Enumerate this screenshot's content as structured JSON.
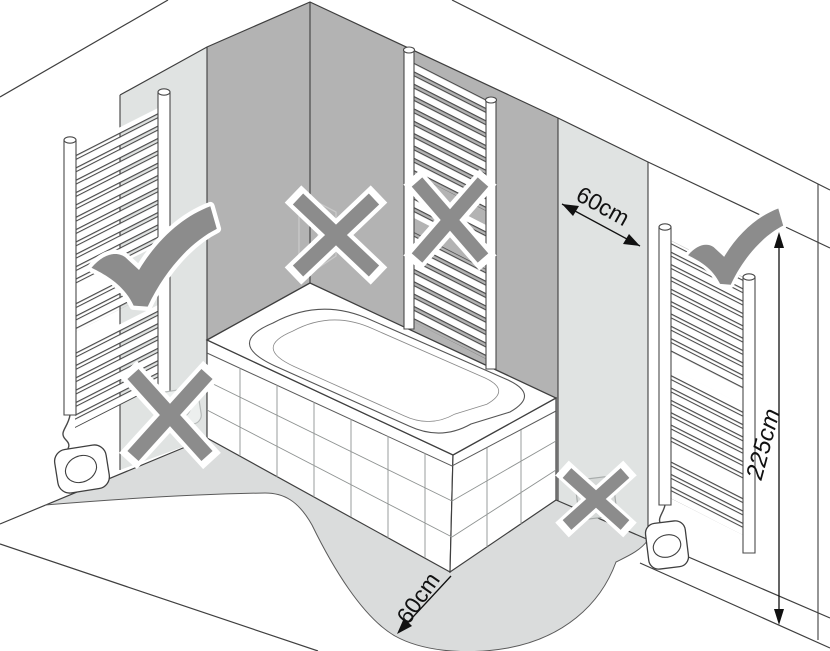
{
  "dimensions": {
    "wall_zone": {
      "label": "60cm"
    },
    "floor_zone": {
      "label": "60cm"
    },
    "height_limit": {
      "label": "225cm"
    }
  },
  "markers": {
    "allowed": [
      "left-wall-towel-radiator",
      "right-wall-towel-radiator-beyond-60cm-strip"
    ],
    "forbidden": [
      "corner-above-bathtub",
      "towel-radiator-above-bathtub",
      "left-wall-socket-near-bathtub",
      "right-wall-socket-near-bathtub"
    ]
  },
  "colors": {
    "wall_dark": "#b3b3b3",
    "wall_strip": "#e0e3e2",
    "floor_zone": "#dadcdc",
    "marker": "#8c8c8c",
    "outline": "#3f3f3f"
  }
}
